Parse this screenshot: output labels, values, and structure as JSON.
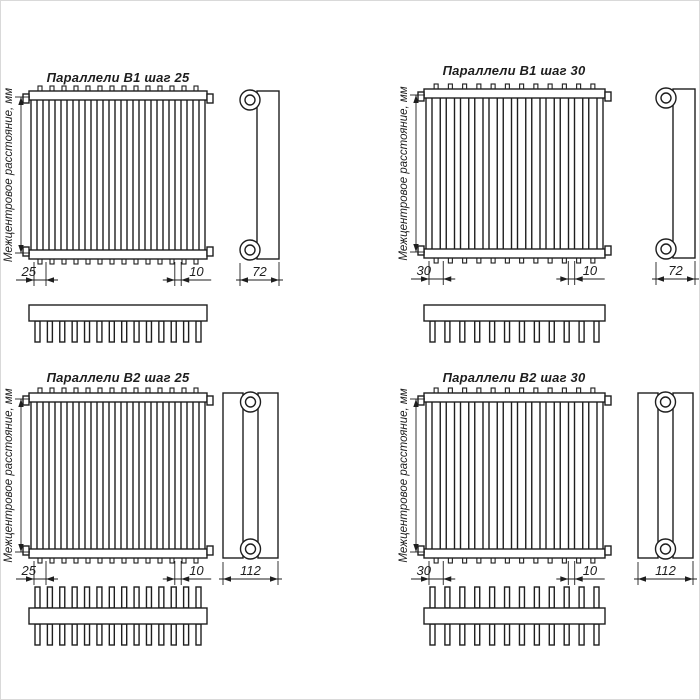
{
  "drawing": {
    "background": "#ffffff",
    "line_color": "#1e1e1e",
    "vertical_axis_label": "Межцентровое расстояние, мм",
    "diagrams": [
      {
        "title": "Параллели В1 шаг 25",
        "model": "B1",
        "step": "25",
        "pitch_label": "25",
        "tube_width_label": "10",
        "depth_label": "72",
        "panels": 1,
        "front_tube_count": 15,
        "top_view_tube_count": 14,
        "top_view_rows": 1
      },
      {
        "title": "Параллели В1 шаг 30",
        "model": "B1",
        "step": "30",
        "pitch_label": "30",
        "tube_width_label": "10",
        "depth_label": "72",
        "panels": 1,
        "front_tube_count": 13,
        "top_view_tube_count": 12,
        "top_view_rows": 1
      },
      {
        "title": "Параллели В2 шаг 25",
        "model": "B2",
        "step": "25",
        "pitch_label": "25",
        "tube_width_label": "10",
        "depth_label": "112",
        "panels": 2,
        "front_tube_count": 15,
        "top_view_tube_count": 14,
        "top_view_rows": 2
      },
      {
        "title": "Параллели В2 шаг 30",
        "model": "B2",
        "step": "30",
        "pitch_label": "30",
        "tube_width_label": "10",
        "depth_label": "112",
        "panels": 2,
        "front_tube_count": 13,
        "top_view_tube_count": 12,
        "top_view_rows": 2
      }
    ]
  }
}
